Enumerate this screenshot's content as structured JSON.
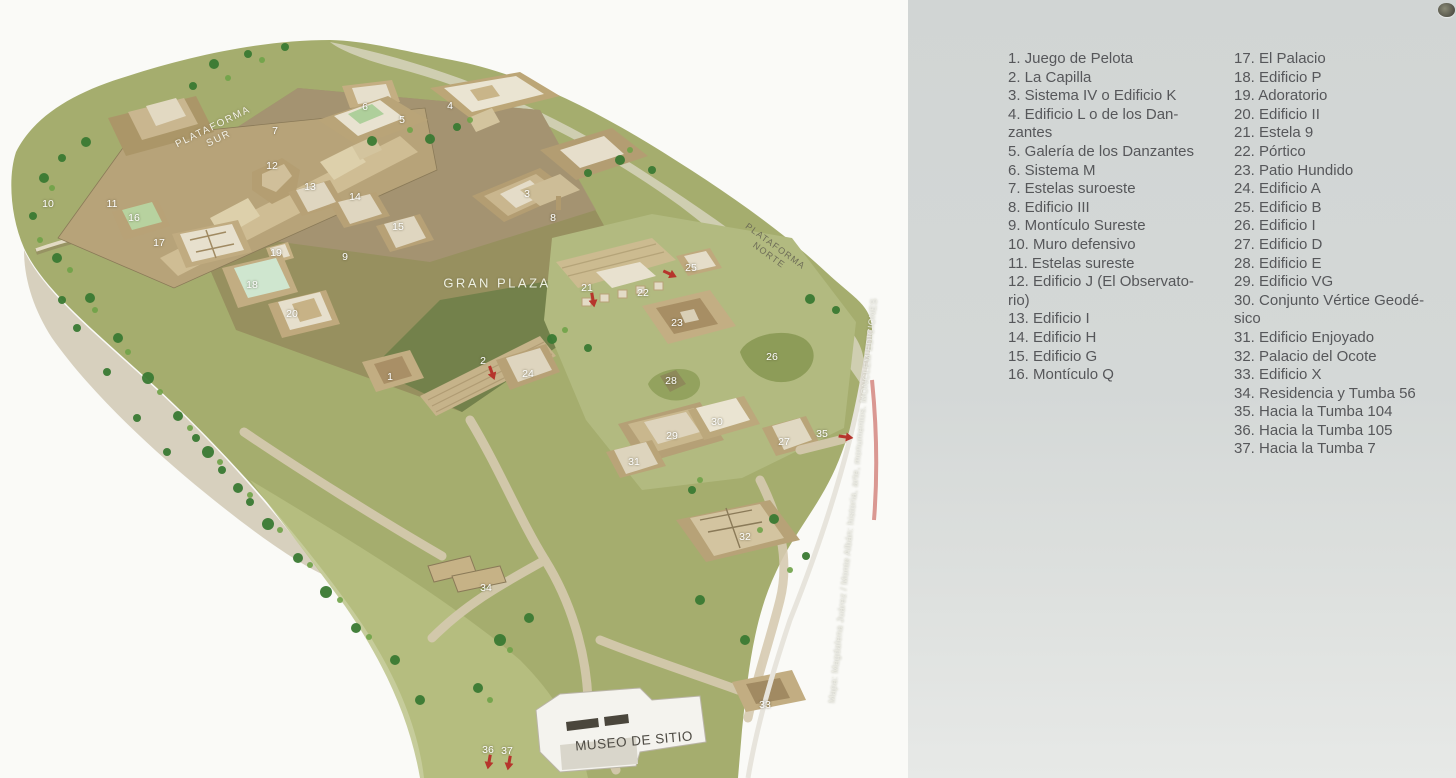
{
  "map": {
    "labels": {
      "plataforma_sur": "PLATAFORMA\nSUR",
      "gran_plaza": "GRAN PLAZA",
      "plataforma_norte": "PLATAFORMA\nNORTE",
      "museo_de_sitio": "MUSEO DE SITIO",
      "credit": "Mapa: Magdalena Juárez / Monte Albán: historia, arte, monumentos. MONCLEM EDICIONES"
    },
    "markers": [
      {
        "n": "1",
        "x": 390,
        "y": 377
      },
      {
        "n": "2",
        "x": 483,
        "y": 361
      },
      {
        "n": "3",
        "x": 527,
        "y": 194
      },
      {
        "n": "4",
        "x": 450,
        "y": 106
      },
      {
        "n": "5",
        "x": 402,
        "y": 120
      },
      {
        "n": "6",
        "x": 365,
        "y": 107
      },
      {
        "n": "7",
        "x": 275,
        "y": 131
      },
      {
        "n": "8",
        "x": 553,
        "y": 218
      },
      {
        "n": "9",
        "x": 345,
        "y": 257
      },
      {
        "n": "10",
        "x": 48,
        "y": 204
      },
      {
        "n": "11",
        "x": 112,
        "y": 204
      },
      {
        "n": "12",
        "x": 272,
        "y": 166
      },
      {
        "n": "13",
        "x": 310,
        "y": 187
      },
      {
        "n": "14",
        "x": 355,
        "y": 197
      },
      {
        "n": "15",
        "x": 398,
        "y": 227
      },
      {
        "n": "16",
        "x": 134,
        "y": 218
      },
      {
        "n": "17",
        "x": 159,
        "y": 243
      },
      {
        "n": "18",
        "x": 252,
        "y": 285
      },
      {
        "n": "19",
        "x": 276,
        "y": 253
      },
      {
        "n": "20",
        "x": 292,
        "y": 314
      },
      {
        "n": "21",
        "x": 587,
        "y": 288
      },
      {
        "n": "22",
        "x": 643,
        "y": 293
      },
      {
        "n": "23",
        "x": 677,
        "y": 323
      },
      {
        "n": "24",
        "x": 528,
        "y": 374
      },
      {
        "n": "25",
        "x": 691,
        "y": 268
      },
      {
        "n": "26",
        "x": 772,
        "y": 357
      },
      {
        "n": "27",
        "x": 784,
        "y": 442
      },
      {
        "n": "28",
        "x": 671,
        "y": 381
      },
      {
        "n": "29",
        "x": 672,
        "y": 436
      },
      {
        "n": "30",
        "x": 717,
        "y": 422
      },
      {
        "n": "31",
        "x": 634,
        "y": 462
      },
      {
        "n": "32",
        "x": 745,
        "y": 537
      },
      {
        "n": "33",
        "x": 765,
        "y": 705
      },
      {
        "n": "34",
        "x": 486,
        "y": 588
      },
      {
        "n": "35",
        "x": 822,
        "y": 434
      },
      {
        "n": "36",
        "x": 488,
        "y": 750
      },
      {
        "n": "37",
        "x": 507,
        "y": 751
      }
    ],
    "arrows": [
      {
        "x": 492,
        "y": 373,
        "angle": 70
      },
      {
        "x": 593,
        "y": 300,
        "angle": 80
      },
      {
        "x": 670,
        "y": 274,
        "angle": 25
      },
      {
        "x": 846,
        "y": 437,
        "angle": 8
      },
      {
        "x": 489,
        "y": 762,
        "angle": 100
      },
      {
        "x": 509,
        "y": 763,
        "angle": 100
      }
    ]
  },
  "legend": {
    "columns": [
      {
        "items": [
          {
            "lines": [
              "1. Juego de Pelota"
            ]
          },
          {
            "lines": [
              "2. La Capilla"
            ]
          },
          {
            "lines": [
              "3. Sistema IV o Edificio K"
            ]
          },
          {
            "lines": [
              "4. Edificio L o de los Dan-",
              "zantes"
            ]
          },
          {
            "lines": [
              "5. Galería de los Danzantes"
            ]
          },
          {
            "lines": [
              "6. Sistema M"
            ]
          },
          {
            "lines": [
              "7. Estelas suroeste"
            ]
          },
          {
            "lines": [
              "8. Edificio III"
            ]
          },
          {
            "lines": [
              "9. Montículo Sureste"
            ]
          },
          {
            "lines": [
              "10. Muro defensivo"
            ]
          },
          {
            "lines": [
              "11. Estelas sureste"
            ]
          },
          {
            "lines": [
              "12. Edificio J (El Observato-",
              "rio)"
            ]
          },
          {
            "lines": [
              "13. Edificio I"
            ]
          },
          {
            "lines": [
              "14. Edificio H"
            ]
          },
          {
            "lines": [
              "15. Edificio G"
            ]
          },
          {
            "lines": [
              "16. Montículo Q"
            ]
          }
        ]
      },
      {
        "items": [
          {
            "lines": [
              "17. El Palacio"
            ]
          },
          {
            "lines": [
              "18. Edificio P"
            ]
          },
          {
            "lines": [
              "19. Adoratorio"
            ]
          },
          {
            "lines": [
              "20. Edificio II"
            ]
          },
          {
            "lines": [
              "21. Estela 9"
            ]
          },
          {
            "lines": [
              "22. Pórtico"
            ]
          },
          {
            "lines": [
              "23. Patio Hundido"
            ]
          },
          {
            "lines": [
              "24. Edificio A"
            ]
          },
          {
            "lines": [
              "25. Edificio B"
            ]
          },
          {
            "lines": [
              "26. Edificio I"
            ]
          },
          {
            "lines": [
              "27. Edificio D"
            ]
          },
          {
            "lines": [
              "28. Edificio E"
            ]
          },
          {
            "lines": [
              "29. Edificio VG"
            ]
          },
          {
            "lines": [
              "30. Conjunto Vértice Geodé-",
              "sico"
            ]
          },
          {
            "lines": [
              "31. Edificio Enjoyado"
            ]
          },
          {
            "lines": [
              "32. Palacio del Ocote"
            ]
          },
          {
            "lines": [
              "33. Edificio X"
            ]
          },
          {
            "lines": [
              "34. Residencia y Tumba 56"
            ]
          },
          {
            "lines": [
              "35. Hacia la Tumba 104"
            ]
          },
          {
            "lines": [
              "36. Hacia la Tumba 105"
            ]
          },
          {
            "lines": [
              "37. Hacia la Tumba 7"
            ]
          }
        ]
      }
    ]
  },
  "colors": {
    "legend_panel_bg": "#d3d7d5",
    "legend_text": "#56575a",
    "arrow_red": "#b6352c",
    "marker_text": "#ffffff",
    "hill_green": "#a5ad6e",
    "plaza_olive": "#97905f"
  }
}
